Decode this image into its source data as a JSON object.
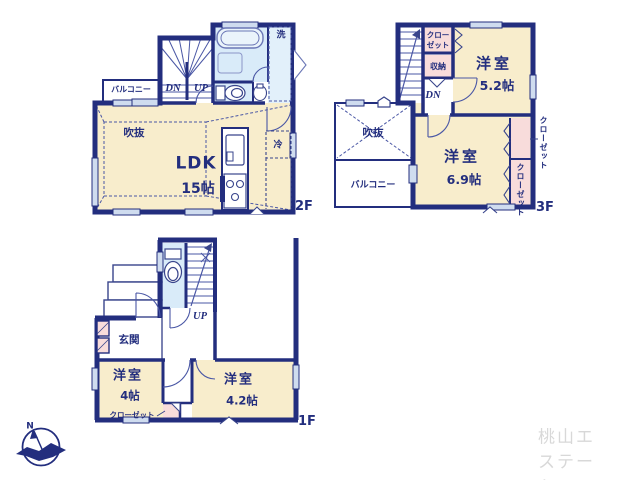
{
  "watermark": "桃山エステート",
  "compass": {
    "north": "N"
  },
  "colors": {
    "wall": "#232e7e",
    "room_cream": "#f8edcc",
    "wet_blue": "#d9ebf9",
    "closet_pink": "#f8dcdb",
    "window_blue": "#cfdcef",
    "watermark_gray": "#d8d8d8"
  },
  "f2": {
    "floor": "2F",
    "ldk": "LDK",
    "ldk_size": "15帖",
    "void": "吹抜",
    "balcony": "バルコニー",
    "wash": "洗",
    "fridge": "冷",
    "dn": "DN",
    "up": "UP"
  },
  "f3": {
    "floor": "3F",
    "room_a": "洋室",
    "room_a_size": "5.2帖",
    "room_b": "洋室",
    "room_b_size": "6.9帖",
    "closet_top_l1": "クロー",
    "closet_top_l2": "ゼット",
    "storage": "収納",
    "dn": "DN",
    "void": "吹抜",
    "balcony": "バルコニー",
    "closet_right_outer": "クローゼット",
    "closet_right_inner": "クローゼット"
  },
  "f1": {
    "floor": "1F",
    "entrance": "玄関",
    "up": "UP",
    "room_a": "洋室",
    "room_a_size": "4帖",
    "room_b": "洋室",
    "room_b_size": "4.2帖",
    "closet": "クローゼット"
  }
}
